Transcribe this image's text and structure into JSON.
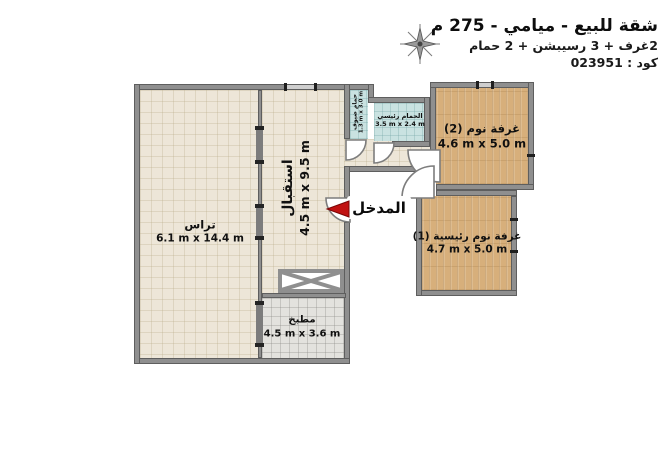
{
  "header": {
    "title": "شقة للبيع - ميامي - 275 م",
    "subtitle": "2غرف + 3 رسيبشن + 2 حمام",
    "code": "كود : 023951"
  },
  "icons": {
    "compass": "compass-rose",
    "entrance_arrow": "red-left-triangle"
  },
  "entrance": {
    "label": "المدخل"
  },
  "rooms": {
    "terrace": {
      "name": "تراس",
      "dims": "6.1 m x 14.4 m"
    },
    "reception": {
      "name": "استقبال",
      "dims": "4.5 m x 9.5 m"
    },
    "guest_bath": {
      "name": "حمام ضيوف",
      "dims": "1.3 m x 3.0 m"
    },
    "main_bath": {
      "name": "الحمام رئيسي",
      "dims": "3.5 m x 2.4 m"
    },
    "bedroom2": {
      "name": "غرفة نوم (2)",
      "dims": "4.6 m x 5.0 m"
    },
    "master_bedroom": {
      "name": "غرفة نوم رئيسية (1)",
      "dims": "4.7 m x 5.0 m"
    },
    "kitchen": {
      "name": "مطبخ",
      "dims": "4.5 m x 3.6 m"
    }
  },
  "colors": {
    "wall": "#8F8F8F",
    "wall_edge": "#5E5E5E",
    "floor_beige": "#EDE6D8",
    "floor_wood": "#D7AF7B",
    "floor_teal": "#C9E2E1",
    "floor_tile": "#E3E2DE",
    "accent_red": "#C11212",
    "text": "#101010"
  }
}
